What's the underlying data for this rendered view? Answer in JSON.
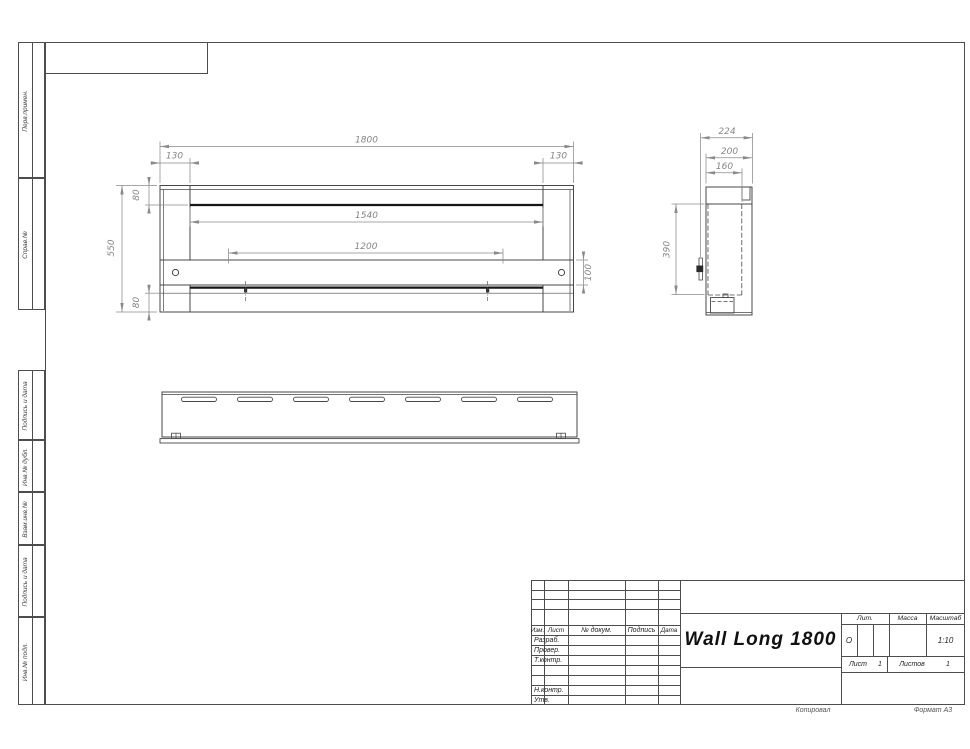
{
  "drawing_title": "Wall Long 1800",
  "margin_labels": [
    "Перв.примен.",
    "Справ.№",
    "Подпись и дата",
    "Инв.№ дубл.",
    "Взам.инв.№",
    "Подпись и дата",
    "Инв.№ подл."
  ],
  "dims": {
    "front": {
      "overall_width": "1800",
      "side_left": "130",
      "side_right": "130",
      "top_offset": "80",
      "height": "550",
      "opening_width": "1540",
      "burner_length": "1200",
      "shelf_height": "100",
      "bottom_offset": "80"
    },
    "side": {
      "depth_overall": "224",
      "depth_body": "200",
      "depth_inner": "160",
      "inner_height": "390"
    }
  },
  "title_block": {
    "headers": {
      "izm": "Изм.",
      "list": "Лист",
      "doc": "№ докум.",
      "sign": "Подпись",
      "date": "Дата"
    },
    "rows": [
      "Разраб.",
      "Провер.",
      "Т.контр.",
      "Н.контр.",
      "Утв."
    ],
    "lit_label": "Лит.",
    "mass_label": "Масса",
    "scale_label": "Масштаб",
    "lit_value": "О",
    "scale_value": "1:10",
    "sheet_label": "Лист",
    "sheet_value": "1",
    "sheets_label": "Листов",
    "sheets_value": "1"
  },
  "footer": {
    "copied": "Копировал",
    "format": "Формат А3"
  }
}
